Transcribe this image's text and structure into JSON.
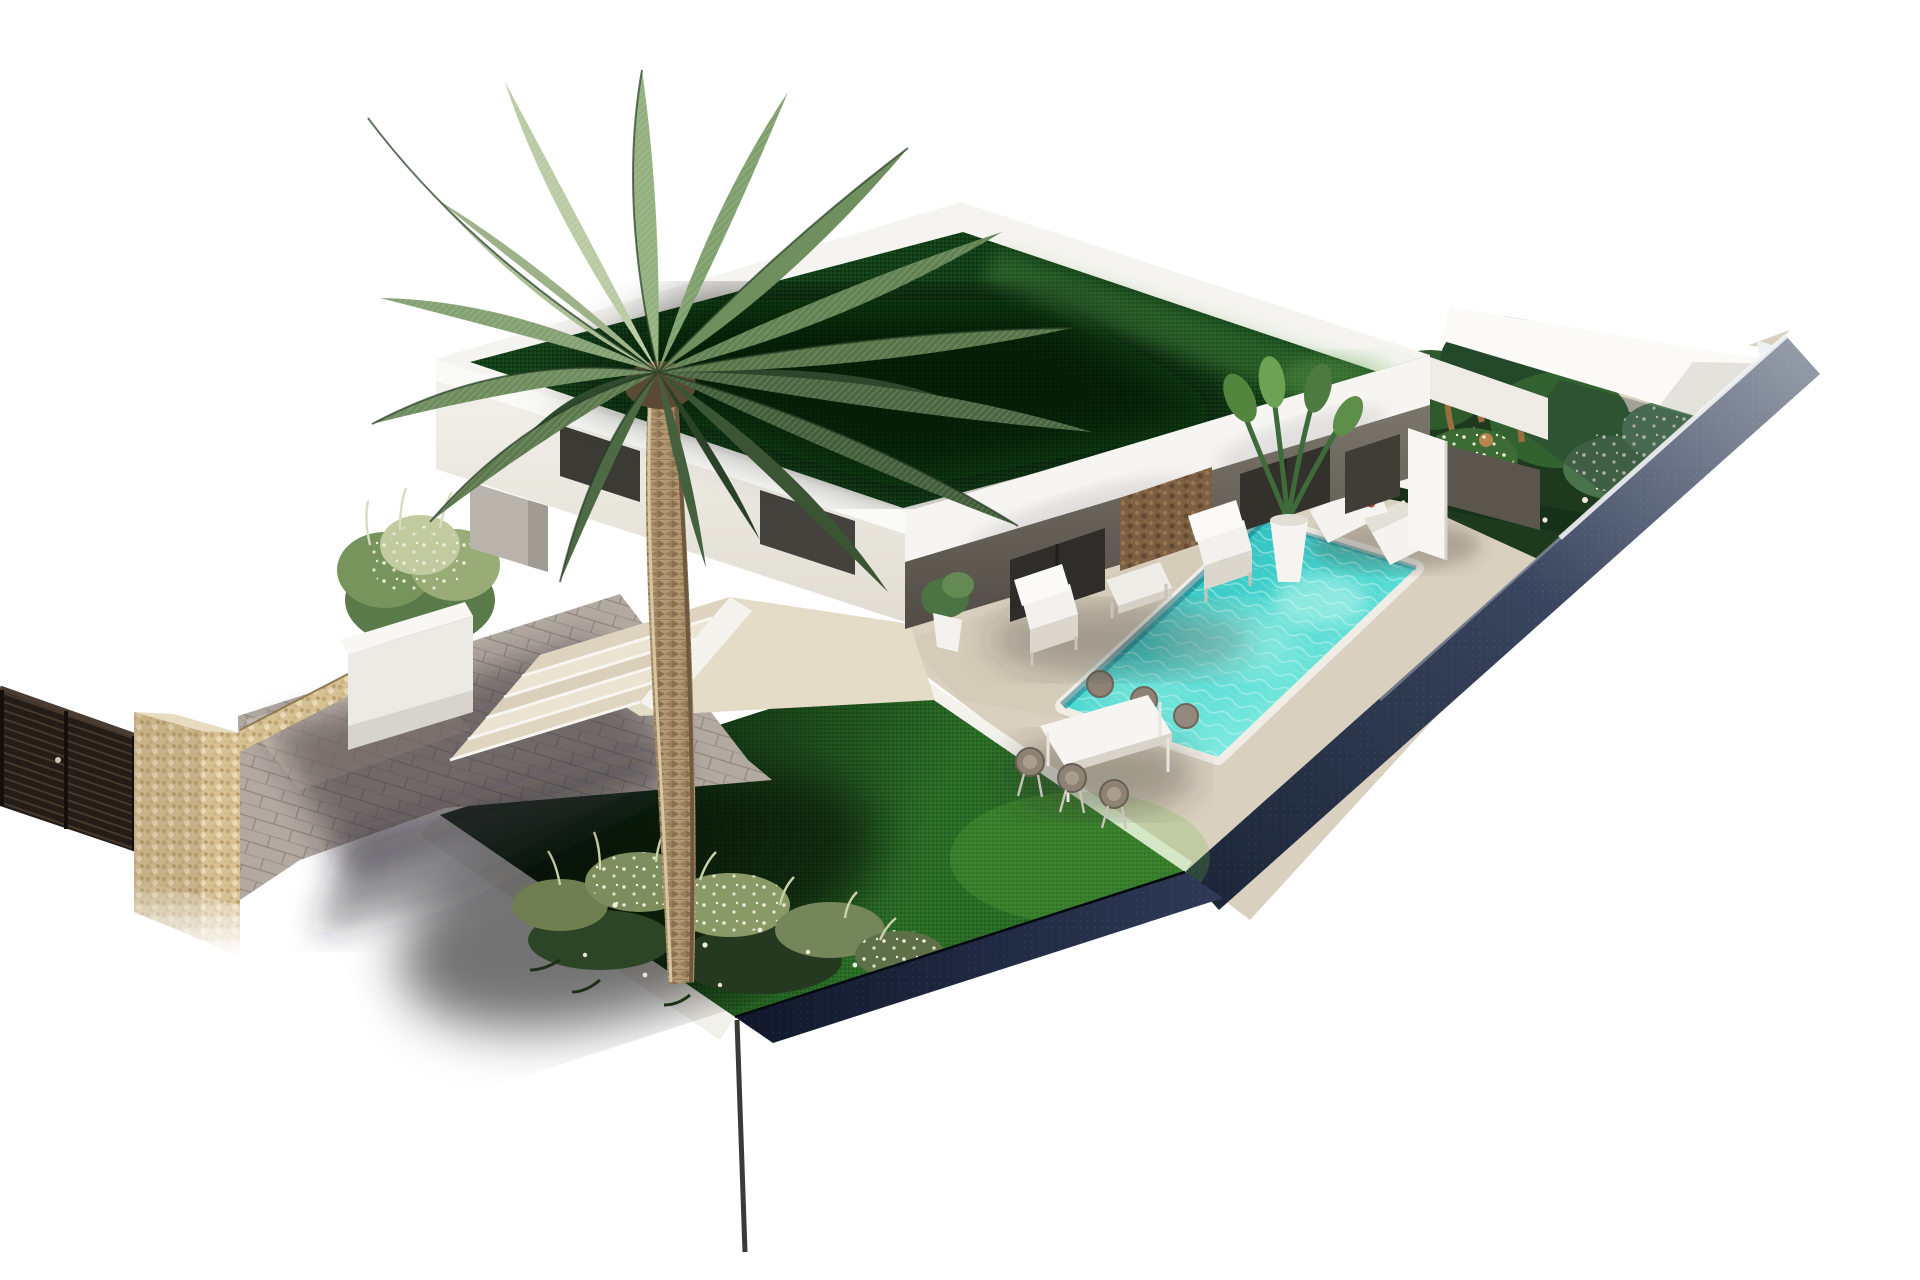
{
  "scene": {
    "type": "3d-architectural-render",
    "description": "Aerial isometric 3D rendering of a modern white single-storey villa on a corner plot: green flat grass roof, shaded front terrace with white lounge furniture, turquoise pool with sun loungers and outdoor dining set, large palm tree over a lawn with flower beds, tropical side garden, paved driveway, stone entrance pillar and dark slatted gate",
    "objects": [
      {
        "id": "slatted-gate",
        "label": "Dark slatted entrance gate"
      },
      {
        "id": "stone-pillar",
        "label": "Natural stone gate pillar"
      },
      {
        "id": "driveway",
        "label": "Grey paved driveway"
      },
      {
        "id": "entry-steps",
        "label": "Entrance steps"
      },
      {
        "id": "planter-box",
        "label": "White planter with shrubs"
      },
      {
        "id": "palm-tree",
        "label": "Large palm tree"
      },
      {
        "id": "front-lawn",
        "label": "Lawn with flower bed"
      },
      {
        "id": "villa",
        "label": "White villa with green flat roof"
      },
      {
        "id": "covered-terrace",
        "label": "Covered terrace with white armchairs"
      },
      {
        "id": "pool",
        "label": "Turquoise swimming pool"
      },
      {
        "id": "sun-loungers",
        "label": "Two white sun loungers"
      },
      {
        "id": "dining-set",
        "label": "Outdoor dining table with six chairs"
      },
      {
        "id": "side-garden",
        "label": "Tropical side garden"
      },
      {
        "id": "boundary-wall",
        "label": "Perimeter wall"
      }
    ],
    "palette": {
      "background": "#ffffff",
      "roof_grass": "#123f18",
      "lawn": "#2a6b26",
      "pool_water": "#45d4cf",
      "deck": "#d9d0bf",
      "driveway": "#b2a9a1",
      "boundary_navy": "#232c44",
      "stone": "#d7c094",
      "gate": "#2a211a",
      "walls": "#f6f5f1",
      "palm_green": "#6f905e",
      "trunk": "#b29872"
    }
  }
}
